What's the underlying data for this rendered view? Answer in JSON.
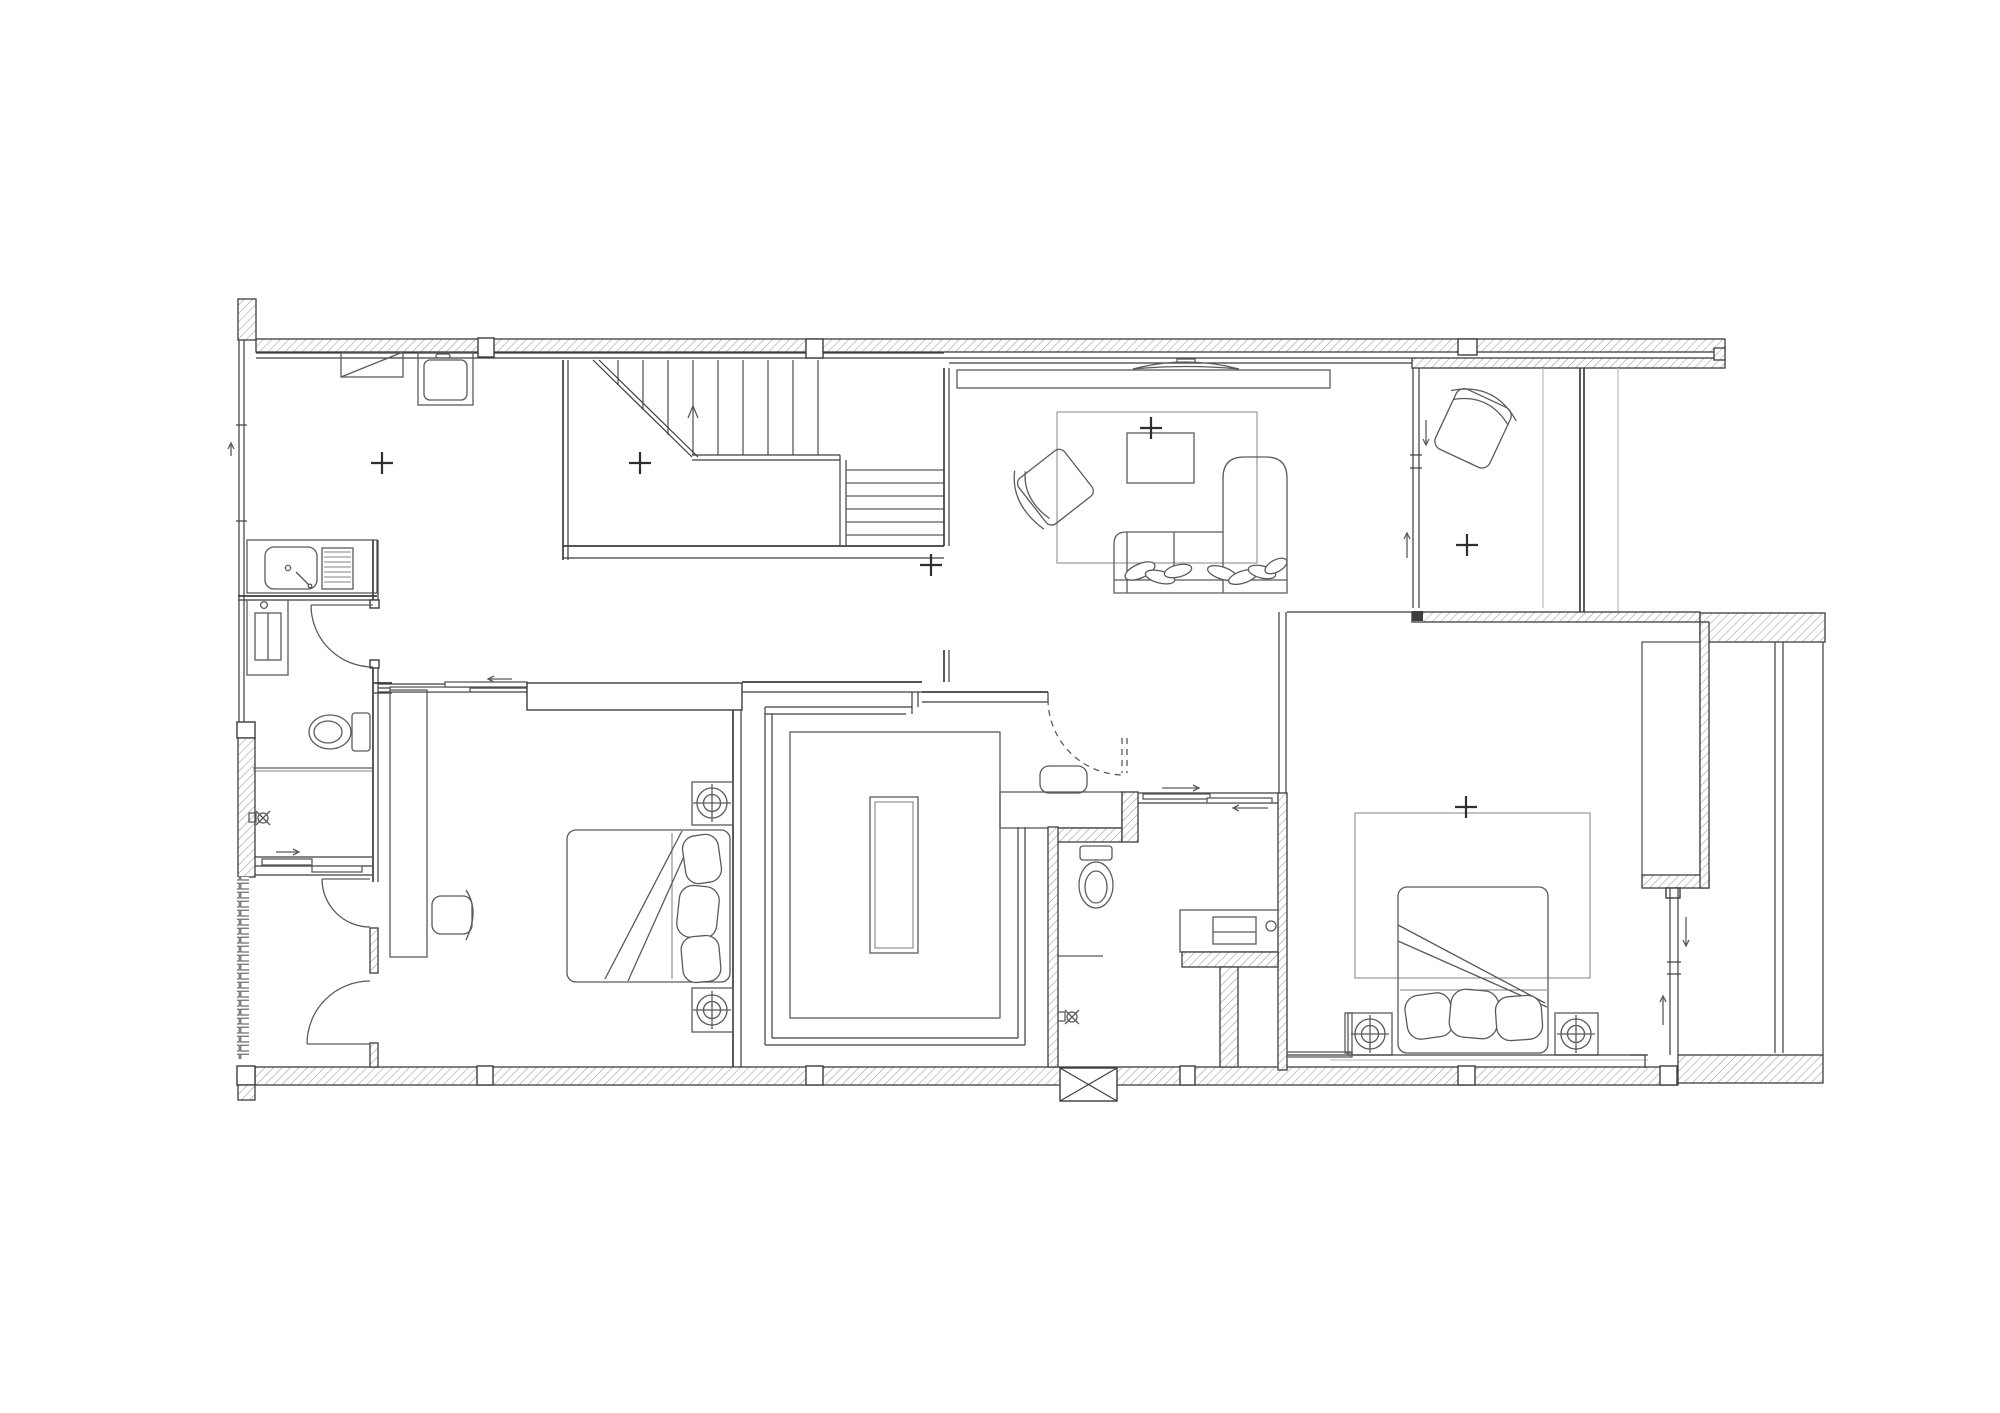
{
  "drawing": {
    "type": "architectural-floor-plan",
    "title": "",
    "visible_text": [],
    "background": "#ffffff",
    "colors": {
      "paper": "#ffffff",
      "wall_line": "#3d3d3d",
      "furniture_line": "#5a5a5a",
      "hatch_line": "#9b9b9b",
      "light_line": "#b3b3b3",
      "marker_line": "#2f2f2f"
    },
    "features": [
      "hatched-exterior-walls",
      "column-blocks",
      "staircase-with-break-line",
      "stair-direction-arrow",
      "kitchenette-sink-counter",
      "drainboard",
      "wall-cabinet",
      "washing-machine",
      "wc-toilet",
      "hinged-doors",
      "sliding-doors",
      "shower-fixtures",
      "bedroom-1-bed-with-pillows",
      "desk-and-chair",
      "bedside-lamp-symbols",
      "walk-in-closet-with-island",
      "hallway",
      "vanity-counter",
      "ottoman",
      "bathroom-toilet",
      "laundry-appliance-counter",
      "floor-hatch-x-box",
      "tv-on-console",
      "living-room-rug",
      "coffee-table",
      "armchair",
      "l-shaped-sofa-with-cushions",
      "lounge-chair",
      "glazed-partitions",
      "bedroom-2-bed-with-rug",
      "wardrobe",
      "sliding-window",
      "side-terrace-glazing",
      "position-cross-markers"
    ],
    "markers": {
      "symbol": "+",
      "count": 6
    }
  }
}
